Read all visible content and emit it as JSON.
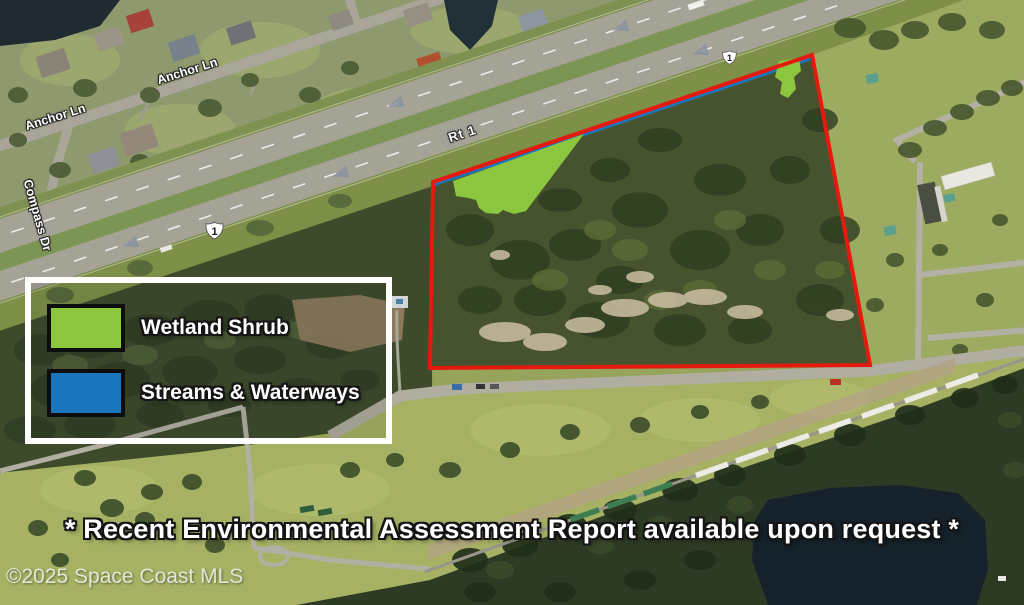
{
  "map": {
    "legend": {
      "items": [
        {
          "label": "Wetland Shrub",
          "color": "#8CC63E"
        },
        {
          "label": "Streams & Waterways",
          "color": "#1B75BC"
        }
      ]
    },
    "annotation": "* Recent Environmental Assessment Report available upon request *",
    "attribution": "©2025 Space Coast MLS",
    "road_labels": {
      "rt1": "Rt 1",
      "anchor_ln_upper": "Anchor Ln",
      "anchor_ln_lower": "Anchor Ln",
      "compass_dr": "Compass Dr"
    },
    "route_shields": [
      {
        "label": "1"
      },
      {
        "label": "1"
      }
    ],
    "overlays": {
      "parcel_boundary_color": "#E6190E",
      "wetland_fill": "#8CC63E",
      "wetland_stroke": "#2C3A12",
      "stream_color": "#1B75BC"
    }
  }
}
